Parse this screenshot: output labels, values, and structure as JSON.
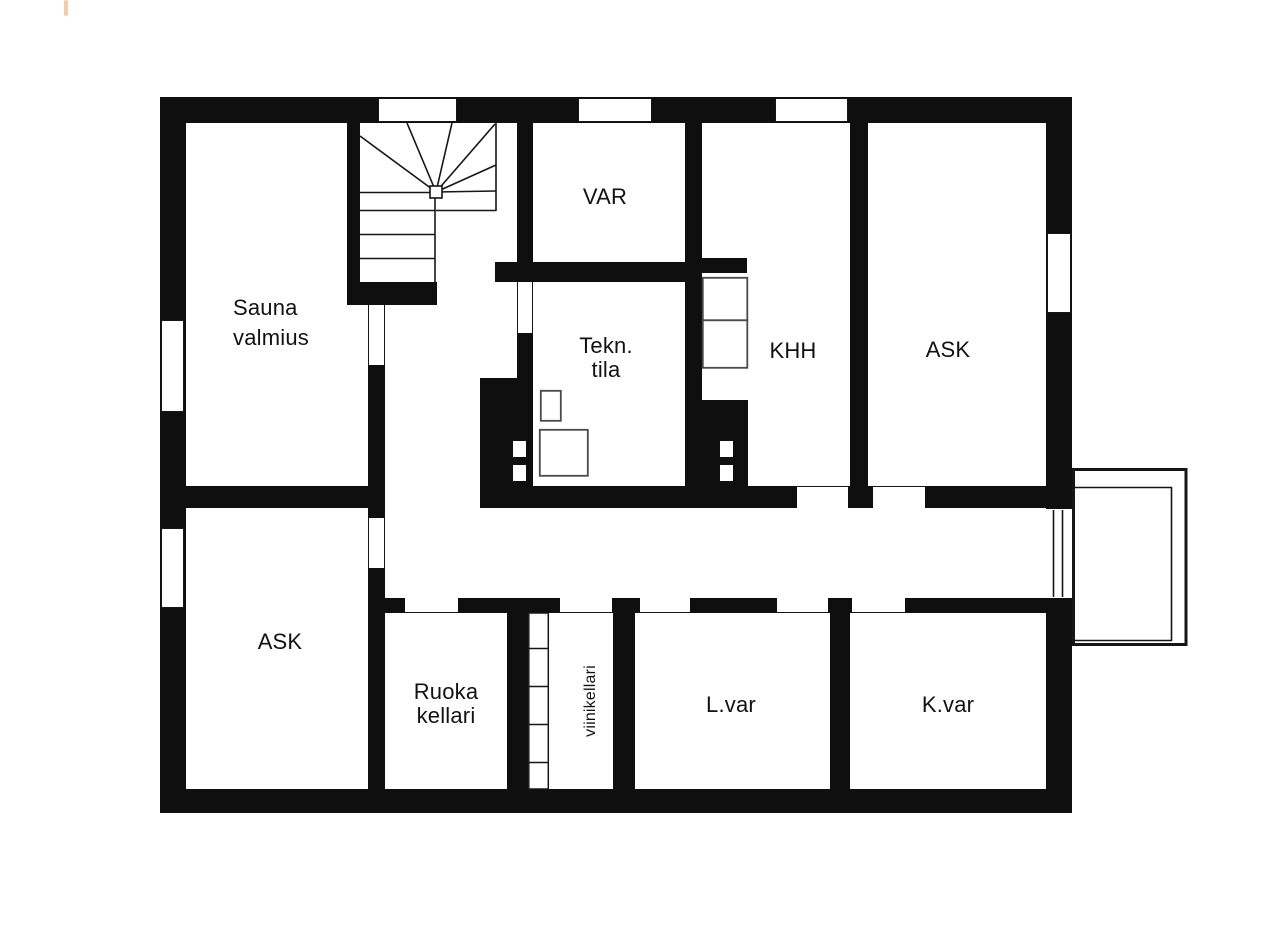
{
  "plan": {
    "kind": "floor-plan",
    "language": "Finnish"
  },
  "rooms": [
    {
      "id": "sauna-valmius",
      "label": "Sauna\nvalmius"
    },
    {
      "id": "var",
      "label": "VAR"
    },
    {
      "id": "tekn-tila",
      "label": "Tekn.\ntila"
    },
    {
      "id": "khh",
      "label": "KHH"
    },
    {
      "id": "ask-upper",
      "label": "ASK"
    },
    {
      "id": "ask-lower",
      "label": "ASK"
    },
    {
      "id": "ruoka-kellari",
      "label": "Ruoka\nkellari"
    },
    {
      "id": "viinikellari",
      "label": "viinikellari"
    },
    {
      "id": "l-var",
      "label": "L.var"
    },
    {
      "id": "k-var",
      "label": "K.var"
    }
  ],
  "colors": {
    "wall": "#0f0f0f",
    "text": "#121212",
    "background": "#ffffff",
    "edge_mark": "#f6caa2"
  }
}
